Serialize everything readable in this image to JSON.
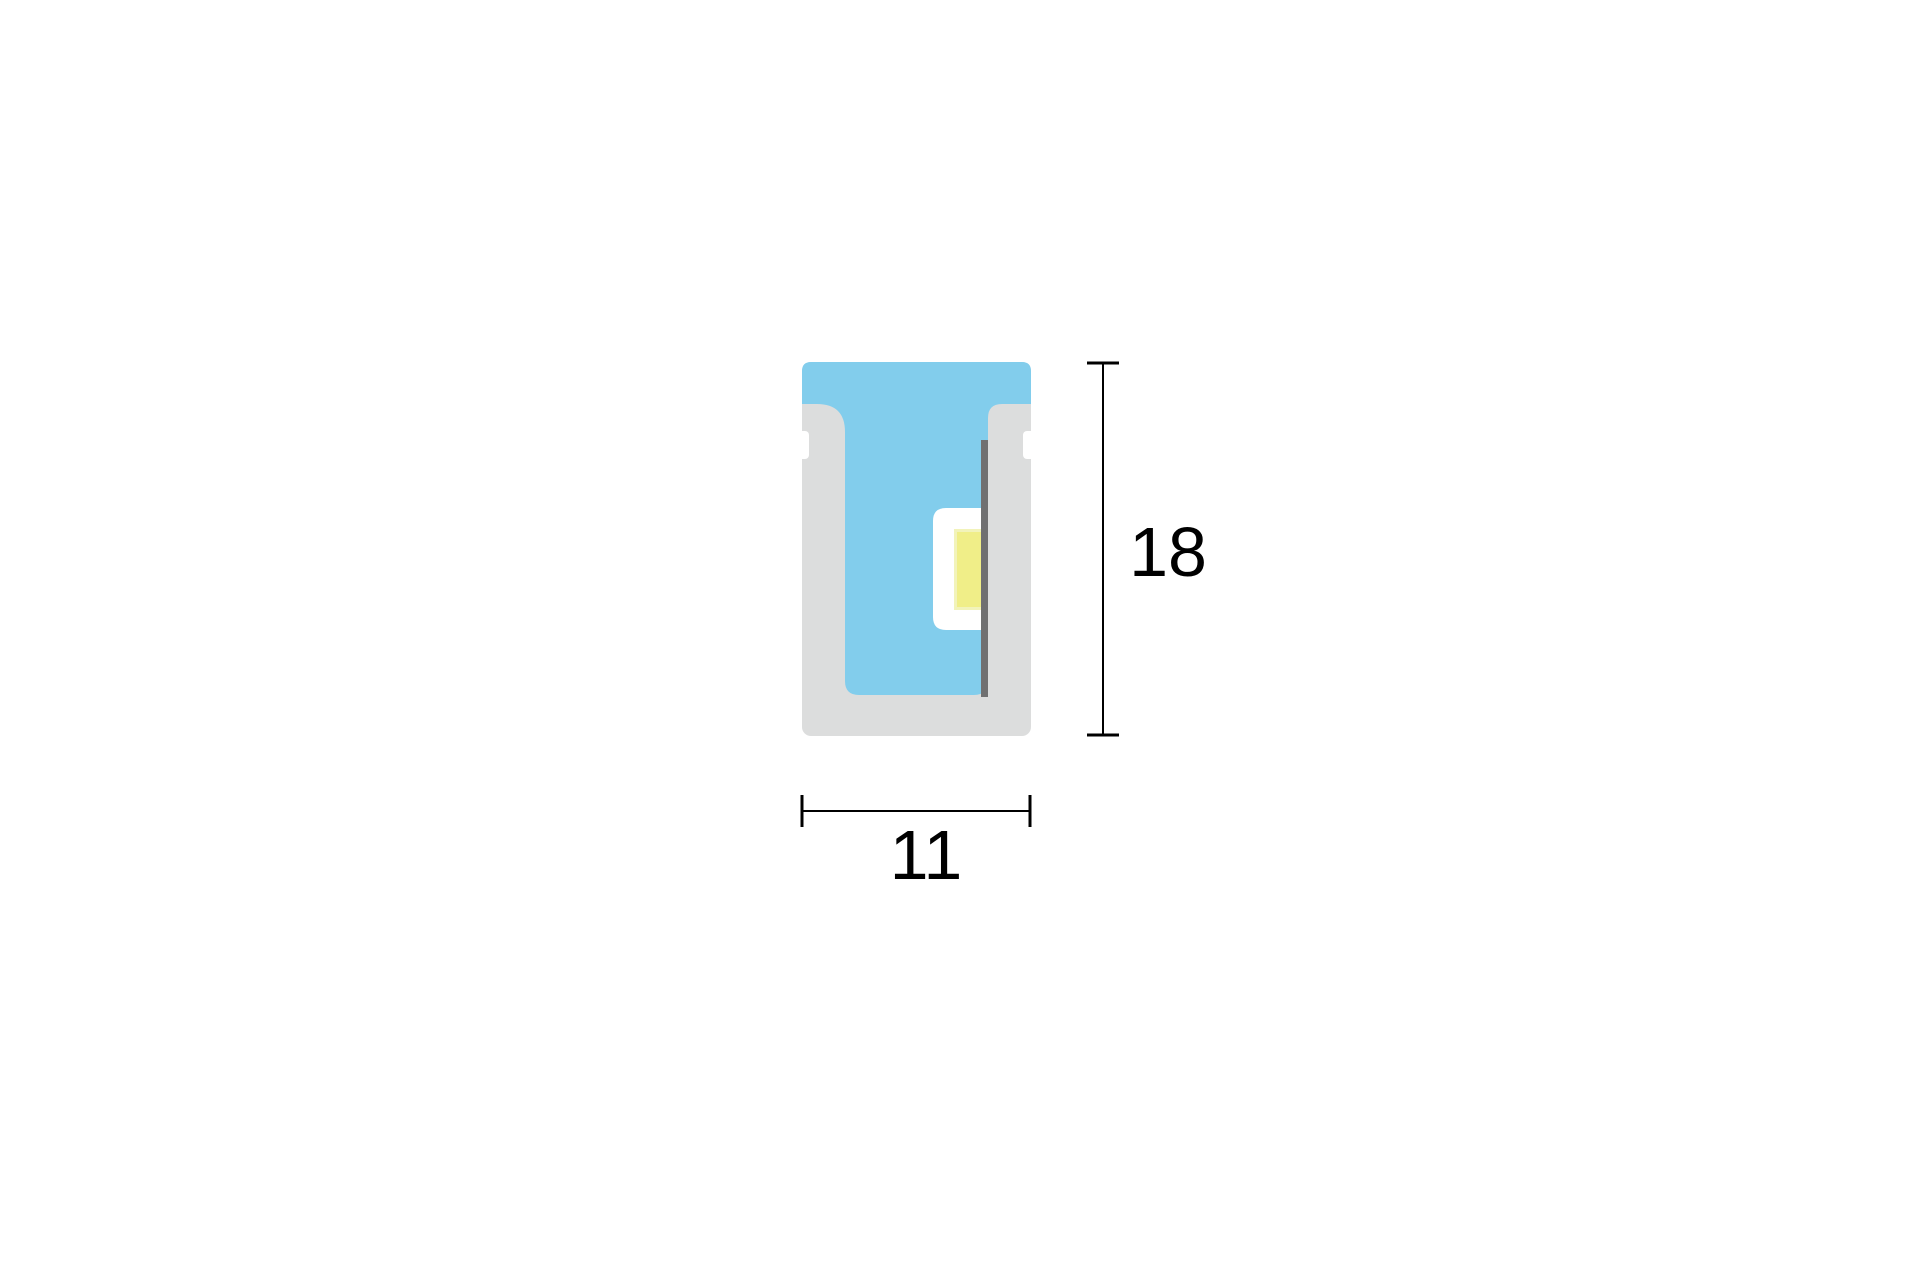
{
  "diagram": {
    "dimension_height": {
      "label": "18"
    },
    "dimension_width": {
      "label": "11"
    }
  },
  "colors": {
    "canvas_background": "#ffffff",
    "housing_silicone_gray": "#dcdddd",
    "diffuser_blue": "#82cdec",
    "pcb_strip_dark_gray": "#707071",
    "led_chip_yellow": "#f0ee88",
    "led_chip_yellow_highlight": "#f2f3ba",
    "led_package_white": "#ffffff",
    "notch_cutout_white": "#ffffff",
    "dimension_line_black": "#000000",
    "dimension_text_black": "#000000"
  }
}
